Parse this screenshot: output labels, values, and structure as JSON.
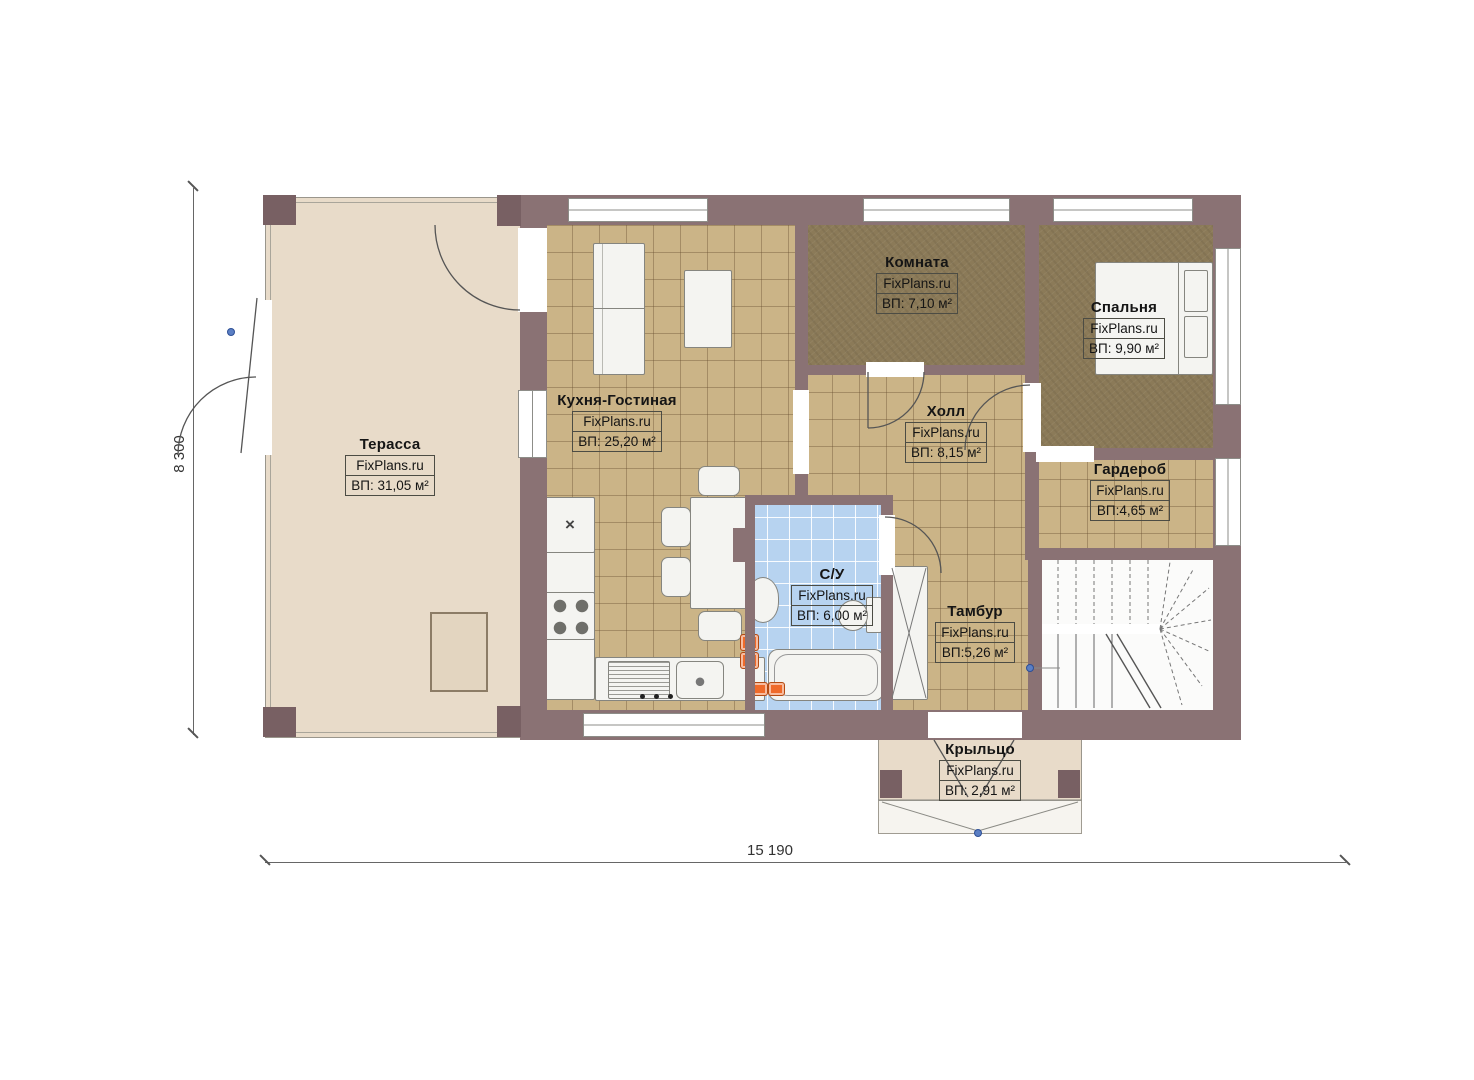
{
  "brand": "FixPlans.ru",
  "dimensions": {
    "height_label": "8 300",
    "width_label": "15 190"
  },
  "rooms": [
    {
      "name": "Терасса",
      "area": "ВП: 31,05 м²"
    },
    {
      "name": "Кухня-Гостиная",
      "area": "ВП: 25,20 м²"
    },
    {
      "name": "Комната",
      "area": "ВП: 7,10 м²"
    },
    {
      "name": "Спальня",
      "area": "ВП: 9,90 м²"
    },
    {
      "name": "Холл",
      "area": "ВП: 8,15 м²"
    },
    {
      "name": "Гардероб",
      "area": "ВП:4,65 м²"
    },
    {
      "name": "С/У",
      "area": "ВП: 6,00 м²"
    },
    {
      "name": "Тамбур",
      "area": "ВП:5,26 м²"
    },
    {
      "name": "Крыльцо",
      "area": "ВП: 2,91 м²"
    }
  ],
  "icons": {
    "sink_cross": "×"
  },
  "colors": {
    "wall": "#8a7274",
    "floor_tile": "#cbb487",
    "floor_wood": "#8b7a58",
    "terrace": "#e8dbc9",
    "bathroom_tile": "#b7d3f0",
    "radiator": "#ef6a2a",
    "marker_dot": "#5b7fc4"
  }
}
